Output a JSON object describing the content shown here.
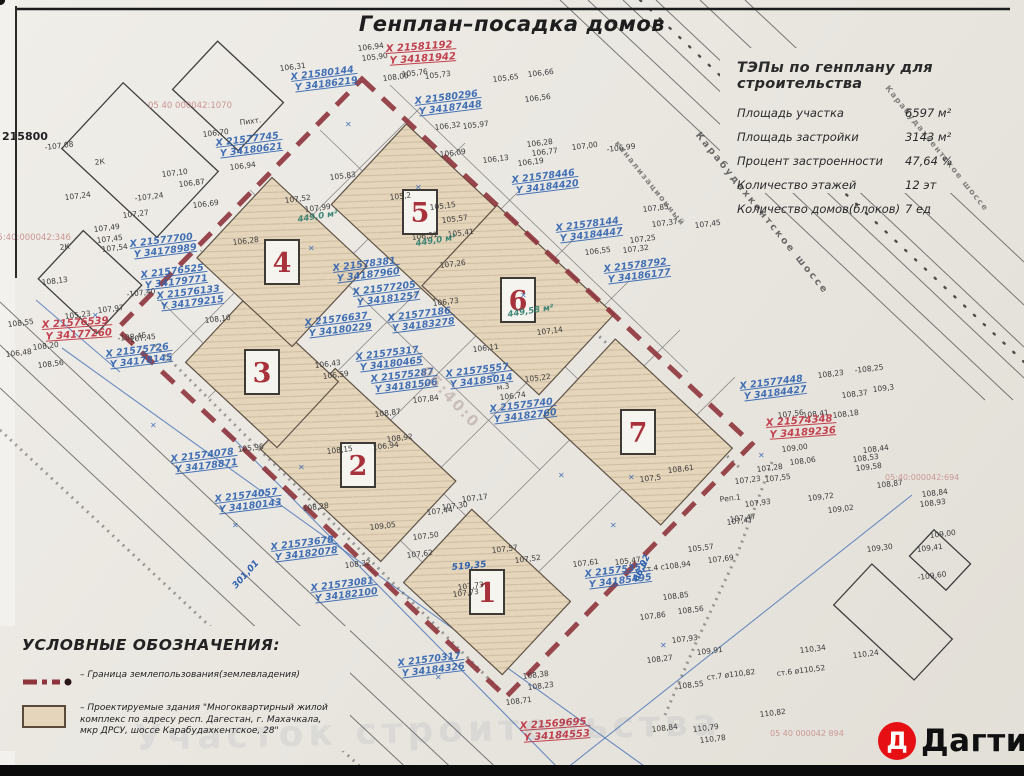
{
  "title": "Генплан–посадка домов",
  "tep": {
    "title": "ТЭПы по генплану для строительства",
    "rows": [
      {
        "label": "Площадь участка",
        "value": "6597 м²"
      },
      {
        "label": "Площадь застройки",
        "value": "3143 м²"
      },
      {
        "label": "Процент застроенности",
        "value": "47,64 %"
      },
      {
        "label": "Количество этажей",
        "value": "12 эт"
      },
      {
        "label": "Количество домов(блоков)",
        "value": "7 ед"
      }
    ]
  },
  "legend": {
    "title": "УСЛОВНЫЕ ОБОЗНАЧЕНИЯ:",
    "boundary_text": "– Граница землепользования(землевладения)",
    "building_text": "– Проектируемые здания \"Многоквартирный жилой комплекс  по адресу респ. Дагестан, г. Махачкала, мкр ДРСУ, шоссе Карабудахкентское, 28\""
  },
  "logo": {
    "letter": "Д",
    "name": "Дагти"
  },
  "colors": {
    "boundary": "#8e343c",
    "blue_ink": "#2e62b0",
    "red_ink": "#c2404e",
    "green_ink": "#2e7d6e",
    "building_fill": "#e5d5ba"
  },
  "plan": {
    "mark_glyph": "✕",
    "buildings": [
      {
        "n": "1",
        "x": 487,
        "y": 592,
        "w": 135,
        "h": 100
      },
      {
        "n": "2",
        "x": 358,
        "y": 465,
        "w": 165,
        "h": 110
      },
      {
        "n": "3",
        "x": 262,
        "y": 372,
        "w": 125,
        "h": 90
      },
      {
        "n": "4",
        "x": 282,
        "y": 262,
        "w": 130,
        "h": 110
      },
      {
        "n": "5",
        "x": 420,
        "y": 212,
        "w": 140,
        "h": 110
      },
      {
        "n": "6",
        "x": 518,
        "y": 300,
        "w": 160,
        "h": 110
      },
      {
        "n": "7",
        "x": 638,
        "y": 432,
        "w": 160,
        "h": 105
      }
    ],
    "corner_points": [
      {
        "x": 362,
        "y": 79
      },
      {
        "x": 752,
        "y": 444
      },
      {
        "x": 506,
        "y": 697
      },
      {
        "x": 117,
        "y": 329
      }
    ],
    "red_coords": [
      {
        "x": 386,
        "y": 52,
        "l1": "X 21581192",
        "l2": "Y 34181942"
      },
      {
        "x": 42,
        "y": 328,
        "l1": "X 21576539",
        "l2": "Y 34177260"
      },
      {
        "x": 766,
        "y": 426,
        "l1": "X 21574348",
        "l2": "Y 34189236"
      },
      {
        "x": 520,
        "y": 729,
        "l1": "X 21569695",
        "l2": "Y 34184553"
      }
    ],
    "blue_coords": [
      {
        "x": 415,
        "y": 104,
        "l1": "X 21580296",
        "l2": "Y 34187448"
      },
      {
        "x": 291,
        "y": 80,
        "l1": "X 21580144",
        "l2": "Y 34186219"
      },
      {
        "x": 216,
        "y": 146,
        "l1": "X 21577745",
        "l2": "Y 34180621"
      },
      {
        "x": 512,
        "y": 183,
        "l1": "X 21578446",
        "l2": "Y 34184420"
      },
      {
        "x": 556,
        "y": 231,
        "l1": "X 21578144",
        "l2": "Y 34184447"
      },
      {
        "x": 604,
        "y": 272,
        "l1": "X 21578792",
        "l2": "Y 34186177"
      },
      {
        "x": 333,
        "y": 271,
        "l1": "X 21578381",
        "l2": "Y 34187960"
      },
      {
        "x": 353,
        "y": 295,
        "l1": "X 21577205",
        "l2": "Y 34181257"
      },
      {
        "x": 305,
        "y": 326,
        "l1": "X 21576637",
        "l2": "Y 34180229"
      },
      {
        "x": 388,
        "y": 321,
        "l1": "X 21577186",
        "l2": "Y 34183278"
      },
      {
        "x": 356,
        "y": 360,
        "l1": "X 21575317",
        "l2": "Y 34180465"
      },
      {
        "x": 371,
        "y": 382,
        "l1": "X 21575287",
        "l2": "Y 34181506"
      },
      {
        "x": 446,
        "y": 377,
        "l1": "X 21575557",
        "l2": "Y 34185014"
      },
      {
        "x": 490,
        "y": 412,
        "l1": "X 21575740",
        "l2": "Y 34182760"
      },
      {
        "x": 130,
        "y": 247,
        "l1": "X 21577700",
        "l2": "Y 34178989"
      },
      {
        "x": 141,
        "y": 278,
        "l1": "X 21576525",
        "l2": "Y 34179771"
      },
      {
        "x": 157,
        "y": 299,
        "l1": "X 21576133",
        "l2": "Y 34179215"
      },
      {
        "x": 106,
        "y": 357,
        "l1": "X 21575726",
        "l2": "Y 34178145"
      },
      {
        "x": 215,
        "y": 502,
        "l1": "X 21574057",
        "l2": "Y 34180143"
      },
      {
        "x": 171,
        "y": 462,
        "l1": "X 21574078",
        "l2": "Y 34178871"
      },
      {
        "x": 271,
        "y": 550,
        "l1": "X 21573678",
        "l2": "Y 34182078"
      },
      {
        "x": 311,
        "y": 591,
        "l1": "X 21573081",
        "l2": "Y 34182100"
      },
      {
        "x": 398,
        "y": 666,
        "l1": "X 21570317",
        "l2": "Y 34184326"
      },
      {
        "x": 585,
        "y": 577,
        "l1": "X 21575357",
        "l2": "Y 34185495"
      },
      {
        "x": 740,
        "y": 389,
        "l1": "X 21577448",
        "l2": "Y 34184427"
      }
    ],
    "areas": [
      {
        "x": 298,
        "y": 222,
        "t": "449,0 м²"
      },
      {
        "x": 416,
        "y": 246,
        "t": "449,0 м²"
      },
      {
        "x": 508,
        "y": 317,
        "t": "449,58 м²"
      }
    ],
    "dims": [
      {
        "x": 452,
        "y": 570,
        "r": -5,
        "t": "519,35"
      },
      {
        "x": 638,
        "y": 582,
        "r": -65,
        "t": "66,02"
      },
      {
        "x": 236,
        "y": 589,
        "r": -48,
        "t": "301,01"
      }
    ],
    "labels": [
      {
        "x": 760,
        "y": 215,
        "r": 51,
        "t": "Карабудахкентское шоссе",
        "cls": "street"
      },
      {
        "x": 935,
        "y": 150,
        "r": 51,
        "t": "Карабудахкентское шоссе",
        "cls": "street-sm"
      },
      {
        "x": 648,
        "y": 185,
        "r": 51,
        "t": "канализационный",
        "cls": "street-sm"
      },
      {
        "x": 148,
        "y": 108,
        "r": 0,
        "t": "05 40 000042:1070",
        "cls": "cad"
      },
      {
        "x": -8,
        "y": 240,
        "r": 0,
        "t": "05:40:000042:346",
        "cls": "cad"
      },
      {
        "x": 885,
        "y": 480,
        "r": 0,
        "t": "05:40:000042:694",
        "cls": "cad-sm"
      },
      {
        "x": 770,
        "y": 736,
        "r": 0,
        "t": "05 40 000042 894",
        "cls": "cad-sm"
      },
      {
        "x": 420,
        "y": 372,
        "r": 47,
        "t": "05:40:0",
        "cls": "cad-big"
      },
      {
        "x": 2,
        "y": 140,
        "r": 0,
        "t": "215800",
        "cls": "edge"
      },
      {
        "x": 135,
        "y": 750,
        "r": -1.5,
        "t": "Участок строительства",
        "cls": "wm"
      }
    ],
    "marks": [
      {
        "x": 345,
        "y": 127
      },
      {
        "x": 308,
        "y": 251
      },
      {
        "x": 490,
        "y": 378
      },
      {
        "x": 558,
        "y": 478
      },
      {
        "x": 610,
        "y": 528
      },
      {
        "x": 660,
        "y": 648
      },
      {
        "x": 150,
        "y": 428
      },
      {
        "x": 232,
        "y": 528
      },
      {
        "x": 92,
        "y": 318
      },
      {
        "x": 758,
        "y": 458
      },
      {
        "x": 520,
        "y": 298
      },
      {
        "x": 435,
        "y": 680
      },
      {
        "x": 415,
        "y": 190
      },
      {
        "x": 628,
        "y": 480
      },
      {
        "x": 298,
        "y": 470
      }
    ],
    "elevations": [
      {
        "x": 45,
        "y": 150,
        "t": "-107,08"
      },
      {
        "x": 65,
        "y": 200,
        "t": "107,24"
      },
      {
        "x": 135,
        "y": 201,
        "t": "-107,24"
      },
      {
        "x": 123,
        "y": 218,
        "t": "107,27"
      },
      {
        "x": 94,
        "y": 232,
        "t": "107,49"
      },
      {
        "x": 97,
        "y": 243,
        "t": "107,45"
      },
      {
        "x": 102,
        "y": 252,
        "t": "107,54"
      },
      {
        "x": 162,
        "y": 177,
        "t": "107,10"
      },
      {
        "x": 179,
        "y": 187,
        "t": "106,87"
      },
      {
        "x": 203,
        "y": 137,
        "t": "106,70"
      },
      {
        "x": 230,
        "y": 170,
        "t": "106,94"
      },
      {
        "x": 193,
        "y": 208,
        "t": "106,69"
      },
      {
        "x": 280,
        "y": 71,
        "t": "106,31"
      },
      {
        "x": 358,
        "y": 51,
        "t": "106,94"
      },
      {
        "x": 362,
        "y": 61,
        "t": "105,90"
      },
      {
        "x": 383,
        "y": 81,
        "t": "108,05"
      },
      {
        "x": 402,
        "y": 77,
        "t": "105,76"
      },
      {
        "x": 425,
        "y": 79,
        "t": "105,73"
      },
      {
        "x": 493,
        "y": 82,
        "t": "105,65"
      },
      {
        "x": 528,
        "y": 77,
        "t": "106,66"
      },
      {
        "x": 525,
        "y": 102,
        "t": "106,56"
      },
      {
        "x": 435,
        "y": 130,
        "t": "106,32"
      },
      {
        "x": 463,
        "y": 129,
        "t": "105,97"
      },
      {
        "x": 440,
        "y": 157,
        "t": "106,09"
      },
      {
        "x": 483,
        "y": 163,
        "t": "106,13"
      },
      {
        "x": 518,
        "y": 166,
        "t": "106,19"
      },
      {
        "x": 527,
        "y": 147,
        "t": "106,28"
      },
      {
        "x": 532,
        "y": 156,
        "t": "106,77"
      },
      {
        "x": 572,
        "y": 150,
        "t": "107,00"
      },
      {
        "x": 607,
        "y": 152,
        "t": "-106,99"
      },
      {
        "x": 643,
        "y": 212,
        "t": "107,85"
      },
      {
        "x": 652,
        "y": 227,
        "t": "107,37"
      },
      {
        "x": 695,
        "y": 228,
        "t": "107,45"
      },
      {
        "x": 585,
        "y": 255,
        "t": "106,55"
      },
      {
        "x": 623,
        "y": 253,
        "t": "107,32"
      },
      {
        "x": 630,
        "y": 243,
        "t": "107,25"
      },
      {
        "x": 330,
        "y": 180,
        "t": "105,83"
      },
      {
        "x": 285,
        "y": 203,
        "t": "107,52"
      },
      {
        "x": 305,
        "y": 212,
        "t": "107,99"
      },
      {
        "x": 233,
        "y": 245,
        "t": "106,28"
      },
      {
        "x": 390,
        "y": 200,
        "t": "105,2"
      },
      {
        "x": 430,
        "y": 210,
        "t": "105,15"
      },
      {
        "x": 442,
        "y": 223,
        "t": "105,57"
      },
      {
        "x": 412,
        "y": 240,
        "t": "106,51"
      },
      {
        "x": 448,
        "y": 237,
        "t": "105,41"
      },
      {
        "x": 440,
        "y": 268,
        "t": "107,26"
      },
      {
        "x": 433,
        "y": 306,
        "t": "106,73"
      },
      {
        "x": 473,
        "y": 352,
        "t": "106,11"
      },
      {
        "x": 315,
        "y": 368,
        "t": "106,43"
      },
      {
        "x": 323,
        "y": 379,
        "t": "106,59"
      },
      {
        "x": 525,
        "y": 382,
        "t": "105,22"
      },
      {
        "x": 537,
        "y": 335,
        "t": "107,14"
      },
      {
        "x": 497,
        "y": 390,
        "t": "м.3"
      },
      {
        "x": 500,
        "y": 400,
        "t": "106,74"
      },
      {
        "x": 413,
        "y": 403,
        "t": "107,84"
      },
      {
        "x": 375,
        "y": 417,
        "t": "108,87"
      },
      {
        "x": 387,
        "y": 442,
        "t": "108,92"
      },
      {
        "x": 373,
        "y": 450,
        "t": "106,94"
      },
      {
        "x": 327,
        "y": 454,
        "t": "108,15"
      },
      {
        "x": 238,
        "y": 452,
        "t": "105,96"
      },
      {
        "x": 462,
        "y": 502,
        "t": "107,17"
      },
      {
        "x": 442,
        "y": 510,
        "t": "107,30"
      },
      {
        "x": 427,
        "y": 515,
        "t": "107,44"
      },
      {
        "x": 413,
        "y": 540,
        "t": "107,50"
      },
      {
        "x": 407,
        "y": 558,
        "t": "107,62"
      },
      {
        "x": 370,
        "y": 530,
        "t": "109,05"
      },
      {
        "x": 303,
        "y": 511,
        "t": "108,28"
      },
      {
        "x": 345,
        "y": 568,
        "t": "108,32"
      },
      {
        "x": 453,
        "y": 597,
        "t": "107,73"
      },
      {
        "x": 492,
        "y": 553,
        "t": "107,57"
      },
      {
        "x": 515,
        "y": 563,
        "t": "107,52"
      },
      {
        "x": 573,
        "y": 567,
        "t": "107,61"
      },
      {
        "x": 615,
        "y": 565,
        "t": "105,47"
      },
      {
        "x": 643,
        "y": 572,
        "t": "ст.4 с108,94"
      },
      {
        "x": 688,
        "y": 552,
        "t": "105,57"
      },
      {
        "x": 727,
        "y": 525,
        "t": "107,47"
      },
      {
        "x": 708,
        "y": 563,
        "t": "107,69"
      },
      {
        "x": 663,
        "y": 600,
        "t": "108,85"
      },
      {
        "x": 678,
        "y": 614,
        "t": "108,56"
      },
      {
        "x": 640,
        "y": 620,
        "t": "107,86"
      },
      {
        "x": 672,
        "y": 643,
        "t": "107,93"
      },
      {
        "x": 697,
        "y": 655,
        "t": "109,91"
      },
      {
        "x": 647,
        "y": 663,
        "t": "108,27"
      },
      {
        "x": 678,
        "y": 689,
        "t": "108,55"
      },
      {
        "x": 707,
        "y": 680,
        "t": "ст.7 ø110,82"
      },
      {
        "x": 777,
        "y": 676,
        "t": "ст.6 ø110,52"
      },
      {
        "x": 800,
        "y": 653,
        "t": "110,34"
      },
      {
        "x": 853,
        "y": 658,
        "t": "110,24"
      },
      {
        "x": 760,
        "y": 717,
        "t": "110,82"
      },
      {
        "x": 652,
        "y": 732,
        "t": "108,84"
      },
      {
        "x": 693,
        "y": 732,
        "t": "110,79"
      },
      {
        "x": 700,
        "y": 743,
        "t": "110,78"
      },
      {
        "x": 918,
        "y": 580,
        "t": "-109,60"
      },
      {
        "x": 867,
        "y": 552,
        "t": "109,30"
      },
      {
        "x": 917,
        "y": 552,
        "t": "109,41"
      },
      {
        "x": 930,
        "y": 538,
        "t": "109,00"
      },
      {
        "x": 920,
        "y": 507,
        "t": "108,93"
      },
      {
        "x": 922,
        "y": 497,
        "t": "108,84"
      },
      {
        "x": 877,
        "y": 488,
        "t": "108,87"
      },
      {
        "x": 818,
        "y": 378,
        "t": "108,23"
      },
      {
        "x": 855,
        "y": 373,
        "t": "-108,25"
      },
      {
        "x": 842,
        "y": 398,
        "t": "108,37"
      },
      {
        "x": 873,
        "y": 392,
        "t": "109,3"
      },
      {
        "x": 833,
        "y": 418,
        "t": "108,18"
      },
      {
        "x": 863,
        "y": 453,
        "t": "108,44"
      },
      {
        "x": 853,
        "y": 462,
        "t": "108,53"
      },
      {
        "x": 856,
        "y": 471,
        "t": "109,58"
      },
      {
        "x": 778,
        "y": 418,
        "t": "107,56"
      },
      {
        "x": 803,
        "y": 418,
        "t": "108,41"
      },
      {
        "x": 782,
        "y": 452,
        "t": "109,00"
      },
      {
        "x": 790,
        "y": 465,
        "t": "108,06"
      },
      {
        "x": 757,
        "y": 472,
        "t": "107,28"
      },
      {
        "x": 765,
        "y": 482,
        "t": "107,55"
      },
      {
        "x": 735,
        "y": 484,
        "t": "107,23"
      },
      {
        "x": 720,
        "y": 502,
        "t": "Реп.1"
      },
      {
        "x": 745,
        "y": 507,
        "t": "107,93"
      },
      {
        "x": 808,
        "y": 501,
        "t": "109,72"
      },
      {
        "x": 828,
        "y": 513,
        "t": "109,02"
      },
      {
        "x": 730,
        "y": 522,
        "t": "107,47"
      },
      {
        "x": 668,
        "y": 473,
        "t": "108,61"
      },
      {
        "x": 640,
        "y": 482,
        "t": "107,5"
      },
      {
        "x": 42,
        "y": 285,
        "t": "108,13"
      },
      {
        "x": 127,
        "y": 297,
        "t": "-107,40"
      },
      {
        "x": 65,
        "y": 319,
        "t": "105,23"
      },
      {
        "x": 98,
        "y": 313,
        "t": "107,97"
      },
      {
        "x": 130,
        "y": 342,
        "t": "107,45"
      },
      {
        "x": 205,
        "y": 323,
        "t": "108,10"
      },
      {
        "x": 33,
        "y": 350,
        "t": "108,20"
      },
      {
        "x": 38,
        "y": 368,
        "t": "108,56"
      },
      {
        "x": 8,
        "y": 327,
        "t": "108,55"
      },
      {
        "x": 6,
        "y": 357,
        "t": "106,48"
      },
      {
        "x": 118,
        "y": 341,
        "t": "-108,45"
      },
      {
        "x": 523,
        "y": 679,
        "t": "108,38"
      },
      {
        "x": 528,
        "y": 690,
        "t": "108,23"
      },
      {
        "x": 506,
        "y": 705,
        "t": "108,71"
      },
      {
        "x": 458,
        "y": 590,
        "t": "107,73"
      },
      {
        "x": 240,
        "y": 125,
        "t": "Пихт."
      },
      {
        "x": 95,
        "y": 165,
        "t": "2К"
      },
      {
        "x": 60,
        "y": 250,
        "t": "2К"
      }
    ]
  }
}
